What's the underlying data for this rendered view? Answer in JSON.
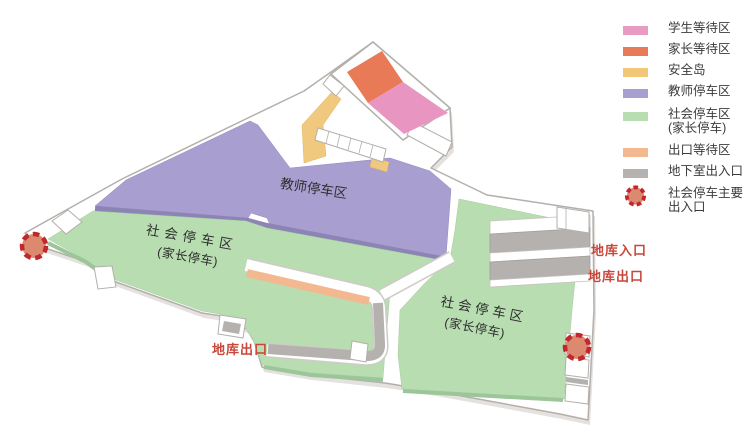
{
  "legend": {
    "items": [
      {
        "label": "学生等待区",
        "color": "#e89bc3",
        "type": "swatch"
      },
      {
        "label": "家长等待区",
        "color": "#e87a58",
        "type": "swatch"
      },
      {
        "label": "安全岛",
        "color": "#f2c878",
        "type": "swatch"
      },
      {
        "label": "教师停车区",
        "color": "#a89fd0",
        "type": "swatch"
      },
      {
        "label": "社会停车区",
        "label2": "(家长停车)",
        "color": "#b7ddb0",
        "type": "swatch"
      },
      {
        "label": "出口等待区",
        "color": "#f4b890",
        "type": "swatch"
      },
      {
        "label": "地下室出入口",
        "color": "#b5b2af",
        "type": "swatch"
      },
      {
        "label": "社会停车主要",
        "label2": "出入口",
        "color": "#db8a70",
        "border_color": "#c1272d",
        "type": "dashed-circle"
      }
    ]
  },
  "map": {
    "teacher_zone_label": "教师停车区",
    "public_zone_left": {
      "line1": "社会停车区",
      "line2": "(家长停车)"
    },
    "public_zone_right": {
      "line1": "社会停车区",
      "line2": "(家长停车)"
    },
    "garage_entrance_label": "地库入口",
    "garage_exit_label_right": "地库出口",
    "garage_exit_label_bottom": "地库出口"
  },
  "colors": {
    "student_wait": "#e89bc3",
    "parent_wait": "#e87a58",
    "safety_island": "#f2c878",
    "teacher_parking": "#a89fd0",
    "public_parking": "#b7ddb0",
    "exit_wait": "#f4b890",
    "basement_access": "#b5b2af",
    "main_entrance_fill": "#db8a70",
    "main_entrance_border": "#c1272d",
    "garage_label_text": "#c9473a"
  }
}
